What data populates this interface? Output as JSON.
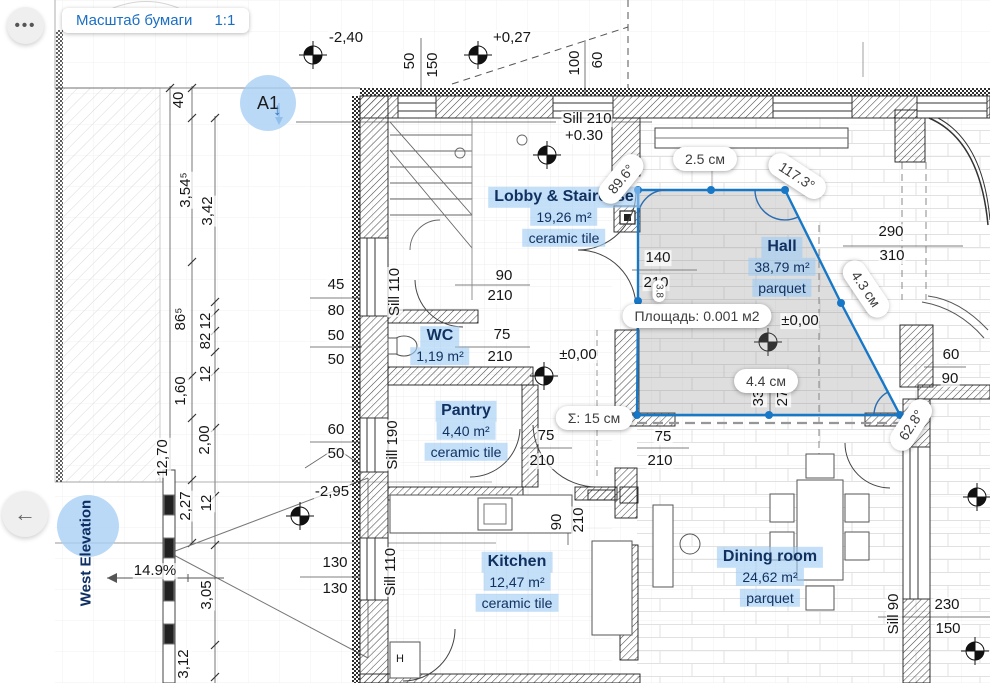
{
  "toolbar": {
    "ellipsis_icon": "•••",
    "scale_label": "Масштаб бумаги",
    "scale_value": "1:1"
  },
  "nav": {
    "back_icon": "←"
  },
  "markers": {
    "a1_label": "A1",
    "a1_arrow_icon": "↓",
    "west_elevation_label": "West Elevation"
  },
  "colors": {
    "accent": "#1878c8",
    "label_text": "#10305f",
    "label_bg": "#a0cbf3",
    "pill_bg": "#ffffff",
    "selection_fill": "rgba(138,138,138,0.28)"
  },
  "selection": {
    "tooltip_area": "Площадь: 0.001 м2",
    "total": "Σ: 15 см",
    "pills": [
      {
        "t": "2.5 см",
        "x": 705,
        "y": 159,
        "r": 0
      },
      {
        "t": "117.3°",
        "x": 797,
        "y": 176,
        "r": 33
      },
      {
        "t": "89.6°",
        "x": 621,
        "y": 179,
        "r": -51
      },
      {
        "t": "4.3 см",
        "x": 866,
        "y": 289,
        "r": 56
      },
      {
        "t": "4.4 см",
        "x": 766,
        "y": 381,
        "r": 0
      },
      {
        "t": "Σ: 15 см",
        "x": 594,
        "y": 418,
        "r": 0
      },
      {
        "t": "Площадь: 0.001 м2",
        "x": 697,
        "y": 316,
        "r": 0
      },
      {
        "t": "3.8",
        "x": 659,
        "y": 291,
        "r": 90,
        "small": true
      },
      {
        "t": "62.8°",
        "x": 911,
        "y": 425,
        "r": -57
      }
    ]
  },
  "rooms": [
    {
      "name": "Lobby & Staircase",
      "area": "19,26 m²",
      "material": "ceramic tile",
      "x": 564,
      "y": 218
    },
    {
      "name": "WC",
      "area": "1,19 m²",
      "material": "",
      "x": 440,
      "y": 347
    },
    {
      "name": "Pantry",
      "area": "4,40 m²",
      "material": "ceramic tile",
      "x": 466,
      "y": 432
    },
    {
      "name": "Kitchen",
      "area": "12,47 m²",
      "material": "ceramic tile",
      "x": 517,
      "y": 583
    },
    {
      "name": "Hall",
      "area": "38,79 m²",
      "material": "parquet",
      "x": 782,
      "y": 268
    },
    {
      "name": "Dining room",
      "area": "24,62 m²",
      "material": "parquet",
      "x": 770,
      "y": 578
    }
  ],
  "dims": [
    {
      "t": "-2,40",
      "x": 346,
      "y": 38
    },
    {
      "t": "50",
      "x": 410,
      "y": 61,
      "r": -90
    },
    {
      "t": "150",
      "x": 433,
      "y": 65,
      "r": -90
    },
    {
      "t": "+0,27",
      "x": 512,
      "y": 38
    },
    {
      "t": "100",
      "x": 575,
      "y": 63,
      "r": -90
    },
    {
      "t": "60",
      "x": 598,
      "y": 60,
      "r": -90
    },
    {
      "t": "Sill 210",
      "x": 587,
      "y": 119
    },
    {
      "t": "+0.30",
      "x": 584,
      "y": 136
    },
    {
      "t": "40",
      "x": 179,
      "y": 100,
      "r": -90
    },
    {
      "t": "3,54⁵",
      "x": 186,
      "y": 190,
      "r": -90
    },
    {
      "t": "3,42",
      "x": 208,
      "y": 211,
      "r": -90
    },
    {
      "t": "86⁵",
      "x": 181,
      "y": 319,
      "r": -90
    },
    {
      "t": "12",
      "x": 206,
      "y": 321,
      "r": -90
    },
    {
      "t": "82",
      "x": 206,
      "y": 341,
      "r": -90
    },
    {
      "t": "12",
      "x": 206,
      "y": 374,
      "r": -90
    },
    {
      "t": "1,60",
      "x": 181,
      "y": 391,
      "r": -90
    },
    {
      "t": "2,00",
      "x": 205,
      "y": 440,
      "r": -90
    },
    {
      "t": "12,70",
      "x": 163,
      "y": 458,
      "r": -90
    },
    {
      "t": "2,27",
      "x": 186,
      "y": 506,
      "r": -90
    },
    {
      "t": "12",
      "x": 207,
      "y": 503,
      "r": -90
    },
    {
      "t": "3,05",
      "x": 207,
      "y": 595,
      "r": -90
    },
    {
      "t": "3,12",
      "x": 184,
      "y": 664,
      "r": -90
    },
    {
      "t": "45",
      "x": 336,
      "y": 285
    },
    {
      "t": "80",
      "x": 336,
      "y": 311
    },
    {
      "t": "50",
      "x": 336,
      "y": 336
    },
    {
      "t": "50",
      "x": 336,
      "y": 360
    },
    {
      "t": "60",
      "x": 336,
      "y": 430
    },
    {
      "t": "50",
      "x": 336,
      "y": 454
    },
    {
      "t": "-2,95",
      "x": 332,
      "y": 492
    },
    {
      "t": "Sill 110",
      "x": 395,
      "y": 292,
      "r": -90
    },
    {
      "t": "Sill 190",
      "x": 393,
      "y": 445,
      "r": -90
    },
    {
      "t": "Sill 110",
      "x": 391,
      "y": 572,
      "r": -90
    },
    {
      "t": "Sill 90",
      "x": 894,
      "y": 614,
      "r": -90
    },
    {
      "t": "90",
      "x": 504,
      "y": 276
    },
    {
      "t": "210",
      "x": 500,
      "y": 296
    },
    {
      "t": "75",
      "x": 502,
      "y": 335
    },
    {
      "t": "210",
      "x": 500,
      "y": 357
    },
    {
      "t": "140",
      "x": 658,
      "y": 258
    },
    {
      "t": "210",
      "x": 656,
      "y": 283
    },
    {
      "t": "75",
      "x": 546,
      "y": 436
    },
    {
      "t": "210",
      "x": 542,
      "y": 461
    },
    {
      "t": "75",
      "x": 663,
      "y": 437
    },
    {
      "t": "210",
      "x": 660,
      "y": 461
    },
    {
      "t": "90",
      "x": 557,
      "y": 522,
      "r": -90
    },
    {
      "t": "210",
      "x": 579,
      "y": 520,
      "r": -90
    },
    {
      "t": "130",
      "x": 335,
      "y": 563
    },
    {
      "t": "130",
      "x": 335,
      "y": 589
    },
    {
      "t": "290",
      "x": 891,
      "y": 232
    },
    {
      "t": "310",
      "x": 892,
      "y": 256
    },
    {
      "t": "60",
      "x": 951,
      "y": 355
    },
    {
      "t": "90",
      "x": 950,
      "y": 379
    },
    {
      "t": "230",
      "x": 947,
      "y": 605
    },
    {
      "t": "150",
      "x": 948,
      "y": 629
    },
    {
      "t": "±0,00",
      "x": 578,
      "y": 355
    },
    {
      "t": "±0,00",
      "x": 800,
      "y": 321
    },
    {
      "t": "33",
      "x": 759,
      "y": 398,
      "r": -90
    },
    {
      "t": "27",
      "x": 783,
      "y": 398,
      "r": -90
    },
    {
      "t": "14.9%",
      "x": 155,
      "y": 571
    },
    {
      "t": "H",
      "x": 400,
      "y": 660,
      "s": 11
    }
  ]
}
